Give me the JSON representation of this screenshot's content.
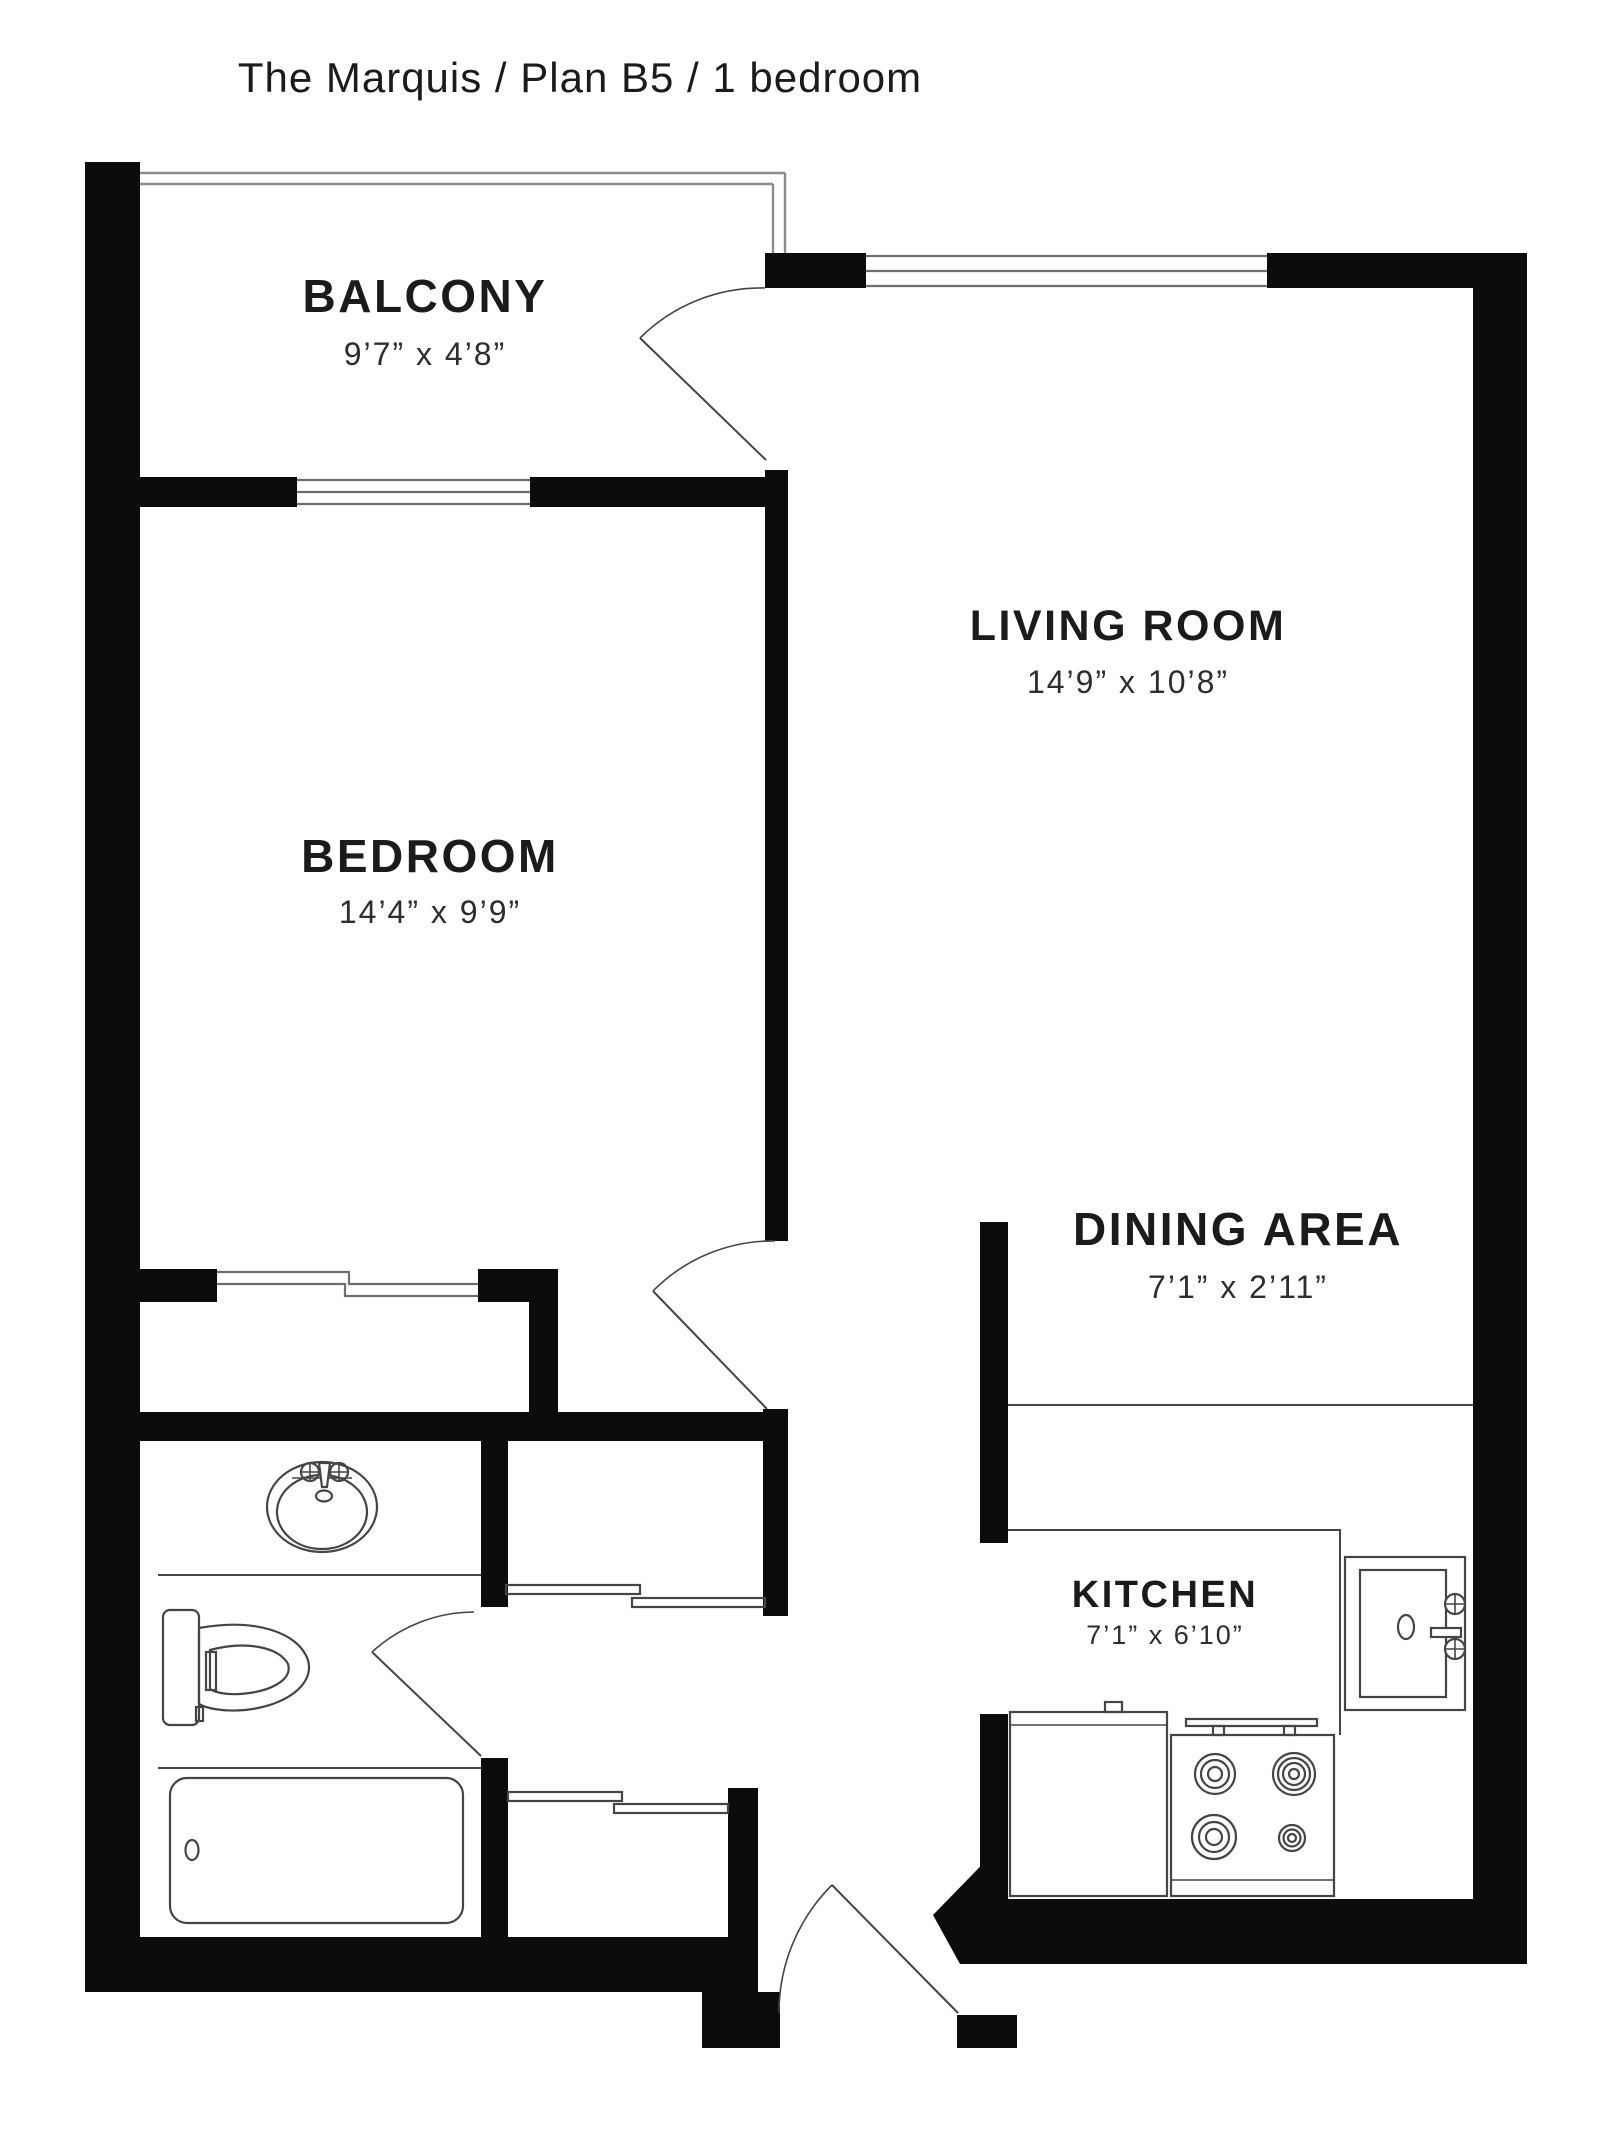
{
  "title": "The Marquis / Plan B5 / 1 bedroom",
  "plan_name": "The Marquis",
  "plan_code": "Plan B5",
  "plan_type": "1 bedroom",
  "rooms": [
    {
      "id": "balcony",
      "label": "BALCONY",
      "dims": "9’7” x 4’8”"
    },
    {
      "id": "living-room",
      "label": "LIVING ROOM",
      "dims": "14’9” x 10’8”"
    },
    {
      "id": "bedroom",
      "label": "BEDROOM",
      "dims": "14’4” x 9’9”"
    },
    {
      "id": "dining-area",
      "label": "DINING AREA",
      "dims": "7’1” x 2’11”"
    },
    {
      "id": "kitchen",
      "label": "KITCHEN",
      "dims": "7’1” x 6’10”"
    }
  ],
  "fixtures": [
    "bathroom-sink-icon",
    "toilet-icon",
    "bathtub-icon",
    "kitchen-sink-icon",
    "refrigerator-icon",
    "stove-icon",
    "range-hood-icon"
  ],
  "colors": {
    "wall": "#0c0c0c",
    "line": "#454545",
    "railing": "#8c8c8c",
    "window": "#6e6e6e",
    "text": "#1b1b1b",
    "dims": "#2e2e2e",
    "background": "#ffffff"
  }
}
